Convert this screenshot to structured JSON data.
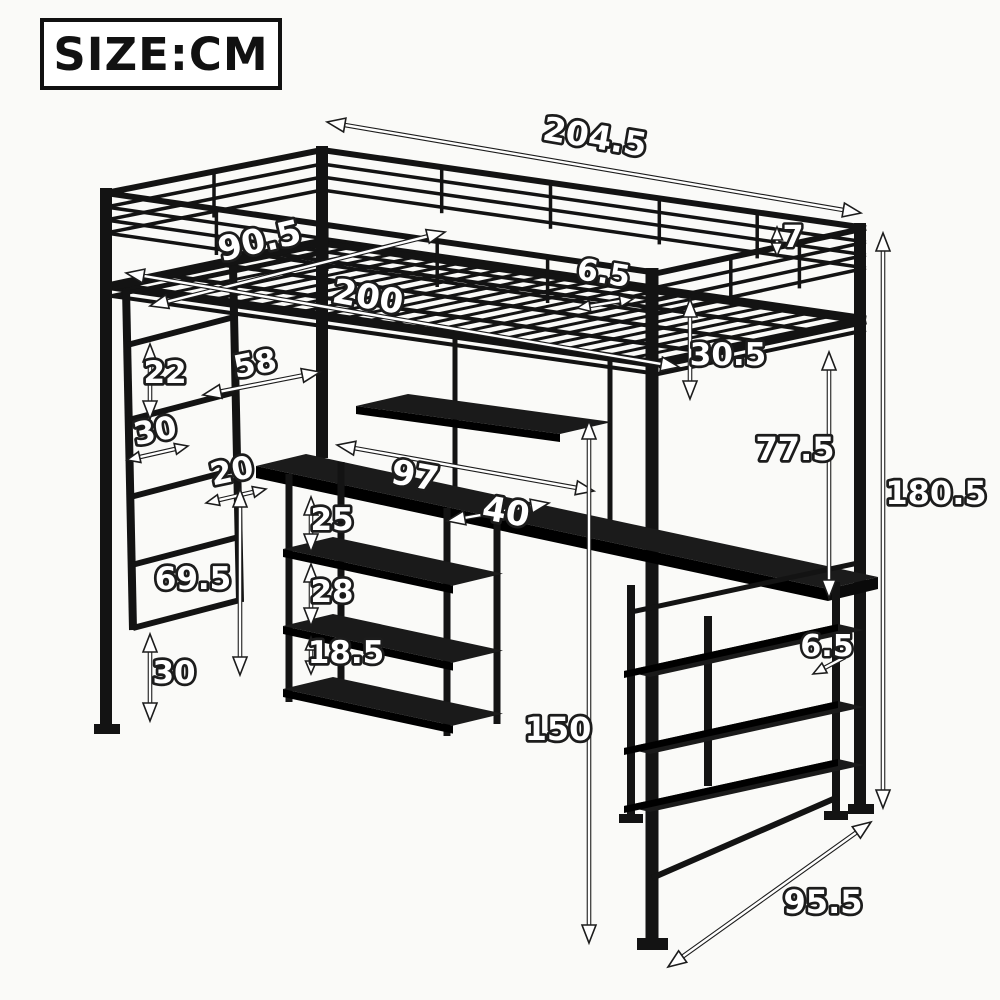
{
  "header": {
    "size_unit_label": "SIZE:CM"
  },
  "diagram": {
    "subject": "black metal loft bed with guardrails, ladder, long desk and storage shelves",
    "unit": "cm",
    "dimensions": {
      "bed_length_overall": "204.5",
      "bed_width": "90.5",
      "sleeping_surface_length": "200",
      "slat_gap": "6.5",
      "guardrail_bar_gap": "7",
      "guardrail_height": "30.5",
      "headboard_to_post_gap": "58",
      "ladder_rung_spacing": "22",
      "ladder_width": "30",
      "ladder_to_shelf_gap": "20",
      "desk_length": "97",
      "desk_depth": "40",
      "shelf_gap_upper": "25",
      "shelf_gap_middle": "28",
      "shelf_gap_lower": "18.5",
      "ladder_bottom_height": "69.5",
      "ladder_ground_clearance": "30",
      "desk_to_bed_clearance": "77.5",
      "overall_height": "180.5",
      "under_bed_height": "150",
      "shelf_board_gap": "6.5",
      "overall_depth": "95.5"
    }
  }
}
